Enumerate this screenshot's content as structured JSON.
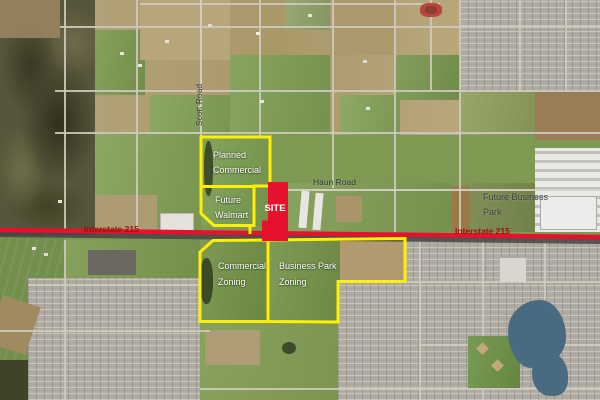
{
  "map": {
    "kind": "annotated aerial zoning exhibit",
    "site": {
      "label": "SITE"
    },
    "overlay_colors": {
      "zone_outline": "#ffef00",
      "highway_line": "#e8112d",
      "site_fill": "#e8112d",
      "interstate_label_color": "#9c1006",
      "zone_label_color": "#ffffff",
      "road_label_color": "#333333"
    },
    "zones": [
      {
        "id": "planned-commercial",
        "lines": [
          "Planned",
          "Commercial"
        ]
      },
      {
        "id": "future-walmart",
        "lines": [
          "Future",
          "Walmart"
        ]
      },
      {
        "id": "commercial-zoning",
        "lines": [
          "Commercial",
          "Zoning"
        ]
      },
      {
        "id": "business-park-zoning",
        "lines": [
          "Business Park",
          "Zoning"
        ]
      },
      {
        "id": "future-business-park",
        "lines": [
          "Future Business",
          "Park"
        ]
      }
    ],
    "roads": {
      "interstate": {
        "name": "Interstate 215",
        "label_occurrences": 2
      },
      "haun": {
        "name": "Haun Road"
      },
      "scott": {
        "name": "Scott Road"
      }
    }
  }
}
